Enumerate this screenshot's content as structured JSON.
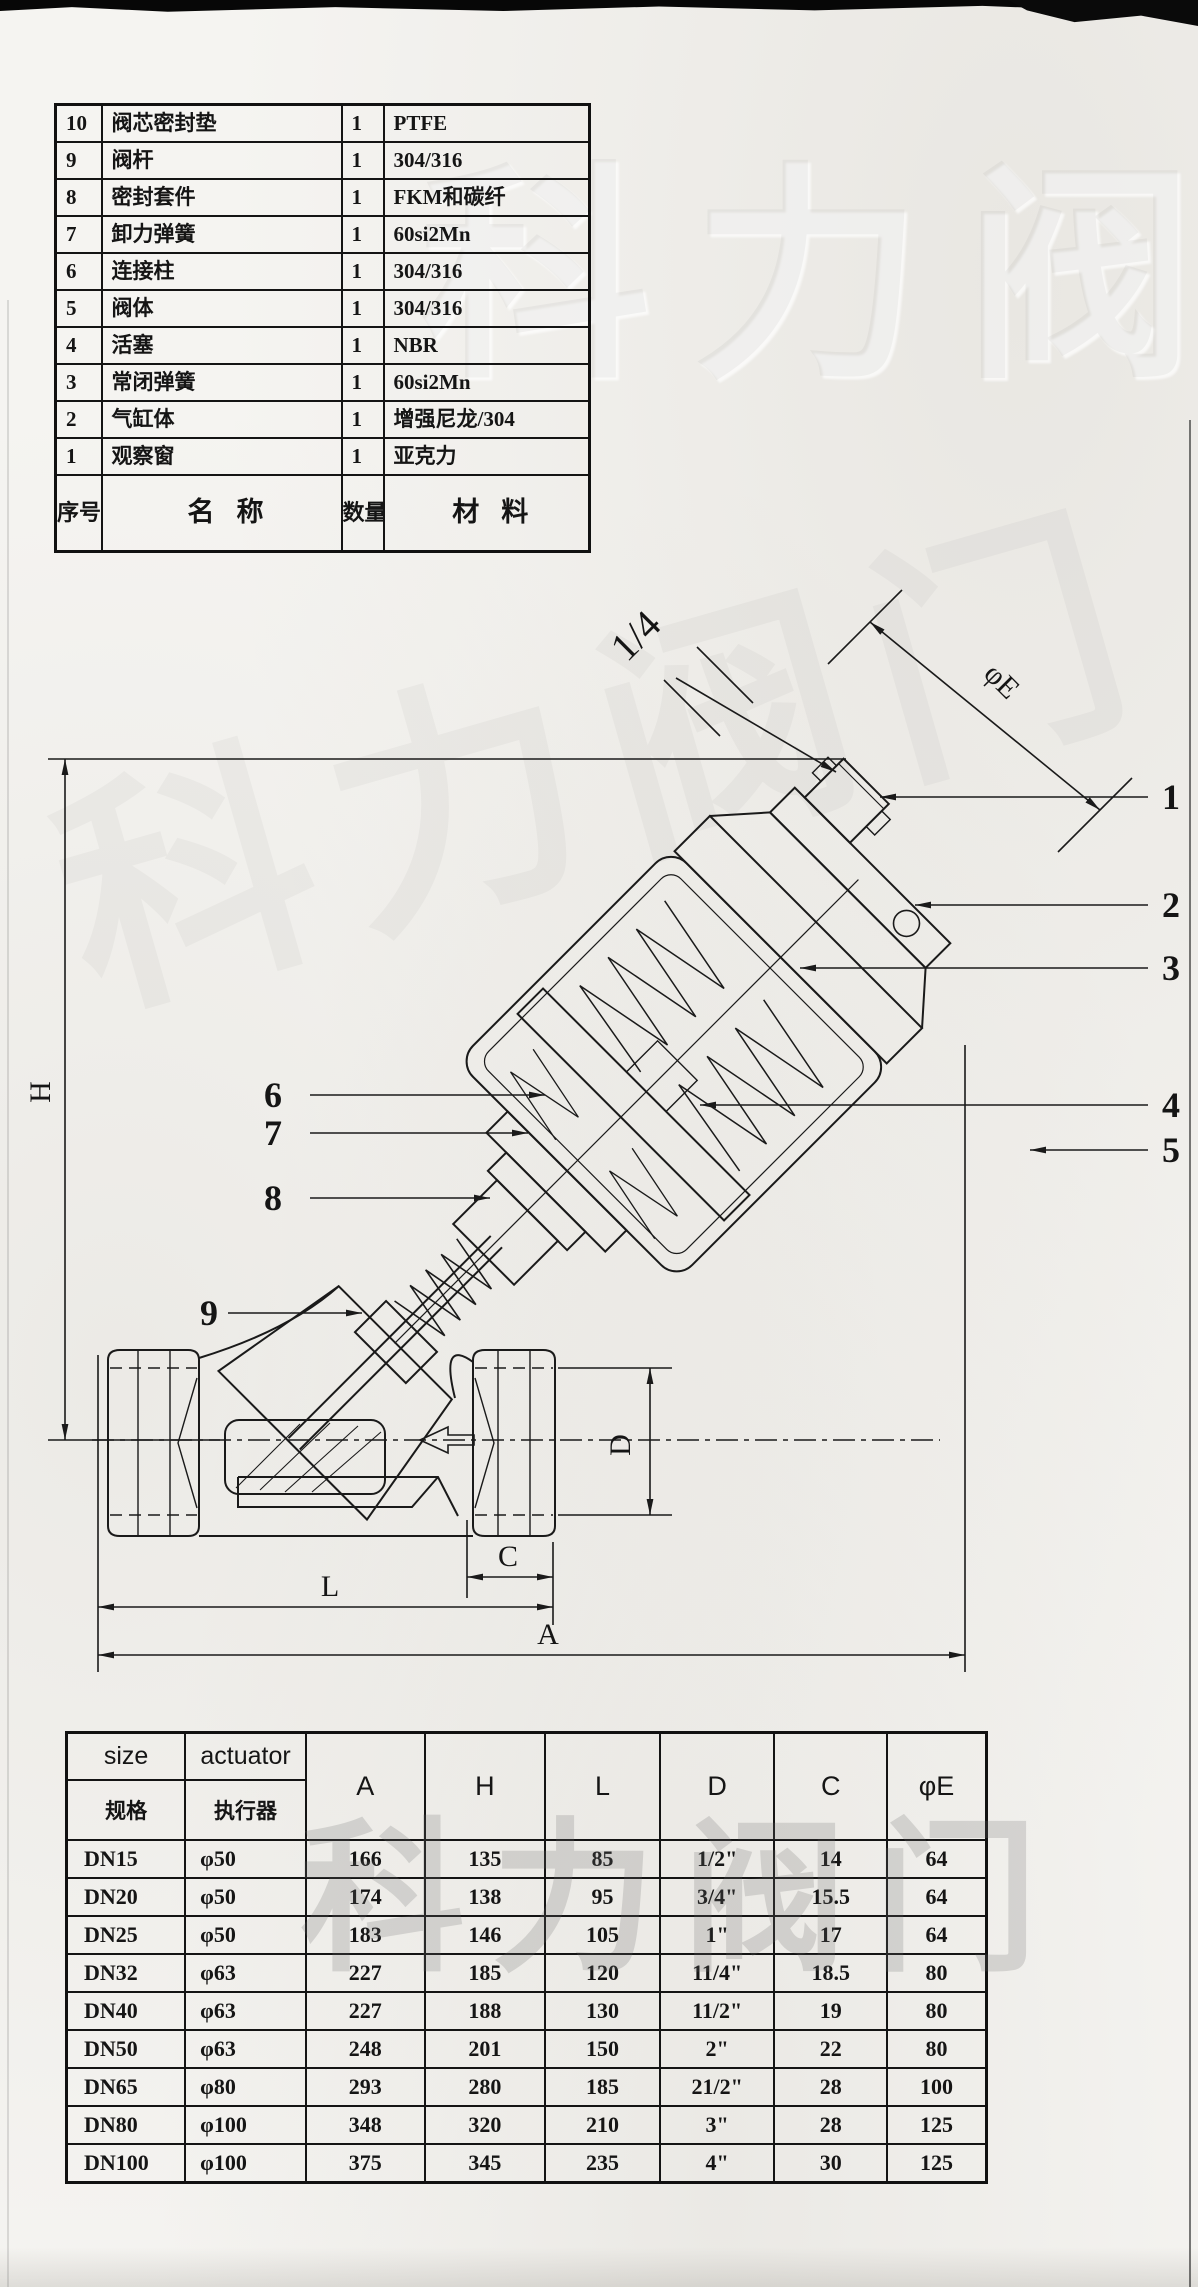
{
  "page": {
    "watermark": "科力阀门"
  },
  "parts_table": {
    "headers": {
      "no": "序号",
      "name": "名称",
      "qty": "数量",
      "material": "材料"
    },
    "rows": [
      {
        "no": "10",
        "name": "阀芯密封垫",
        "qty": "1",
        "material": "PTFE"
      },
      {
        "no": "9",
        "name": "阀杆",
        "qty": "1",
        "material": "304/316"
      },
      {
        "no": "8",
        "name": "密封套件",
        "qty": "1",
        "material": "FKM和碳纤"
      },
      {
        "no": "7",
        "name": "卸力弹簧",
        "qty": "1",
        "material": "60si2Mn"
      },
      {
        "no": "6",
        "name": "连接柱",
        "qty": "1",
        "material": "304/316"
      },
      {
        "no": "5",
        "name": "阀体",
        "qty": "1",
        "material": "304/316"
      },
      {
        "no": "4",
        "name": "活塞",
        "qty": "1",
        "material": "NBR"
      },
      {
        "no": "3",
        "name": "常闭弹簧",
        "qty": "1",
        "material": "60si2Mn"
      },
      {
        "no": "2",
        "name": "气缸体",
        "qty": "1",
        "material": "增强尼龙/304"
      },
      {
        "no": "1",
        "name": "观察窗",
        "qty": "1",
        "material": "亚克力"
      }
    ]
  },
  "drawing": {
    "dim_labels": {
      "air_port": "1/4",
      "phi_e": "φE",
      "h": "H",
      "d": "D",
      "c": "C",
      "l": "L",
      "a": "A"
    },
    "callouts": {
      "c1": "1",
      "c2": "2",
      "c3": "3",
      "c4": "4",
      "c5": "5",
      "c6": "6",
      "c7": "7",
      "c8": "8",
      "c9": "9"
    }
  },
  "dims_table": {
    "header": {
      "size_en": "size",
      "size_zh": "规格",
      "actuator_en": "actuator",
      "actuator_zh": "执行器",
      "cols": [
        "A",
        "H",
        "L",
        "D",
        "C",
        "φE"
      ]
    },
    "rows": [
      {
        "size": "DN15",
        "actuator": "φ50",
        "A": "166",
        "H": "135",
        "L": "85",
        "D": "1/2\"",
        "C": "14",
        "E": "64"
      },
      {
        "size": "DN20",
        "actuator": "φ50",
        "A": "174",
        "H": "138",
        "L": "95",
        "D": "3/4\"",
        "C": "15.5",
        "E": "64"
      },
      {
        "size": "DN25",
        "actuator": "φ50",
        "A": "183",
        "H": "146",
        "L": "105",
        "D": "1\"",
        "C": "17",
        "E": "64"
      },
      {
        "size": "DN32",
        "actuator": "φ63",
        "A": "227",
        "H": "185",
        "L": "120",
        "D": "11/4\"",
        "C": "18.5",
        "E": "80"
      },
      {
        "size": "DN40",
        "actuator": "φ63",
        "A": "227",
        "H": "188",
        "L": "130",
        "D": "11/2\"",
        "C": "19",
        "E": "80"
      },
      {
        "size": "DN50",
        "actuator": "φ63",
        "A": "248",
        "H": "201",
        "L": "150",
        "D": "2\"",
        "C": "22",
        "E": "80"
      },
      {
        "size": "DN65",
        "actuator": "φ80",
        "A": "293",
        "H": "280",
        "L": "185",
        "D": "21/2\"",
        "C": "28",
        "E": "100"
      },
      {
        "size": "DN80",
        "actuator": "φ100",
        "A": "348",
        "H": "320",
        "L": "210",
        "D": "3\"",
        "C": "28",
        "E": "125"
      },
      {
        "size": "DN100",
        "actuator": "φ100",
        "A": "375",
        "H": "345",
        "L": "235",
        "D": "4\"",
        "C": "30",
        "E": "125"
      }
    ]
  }
}
